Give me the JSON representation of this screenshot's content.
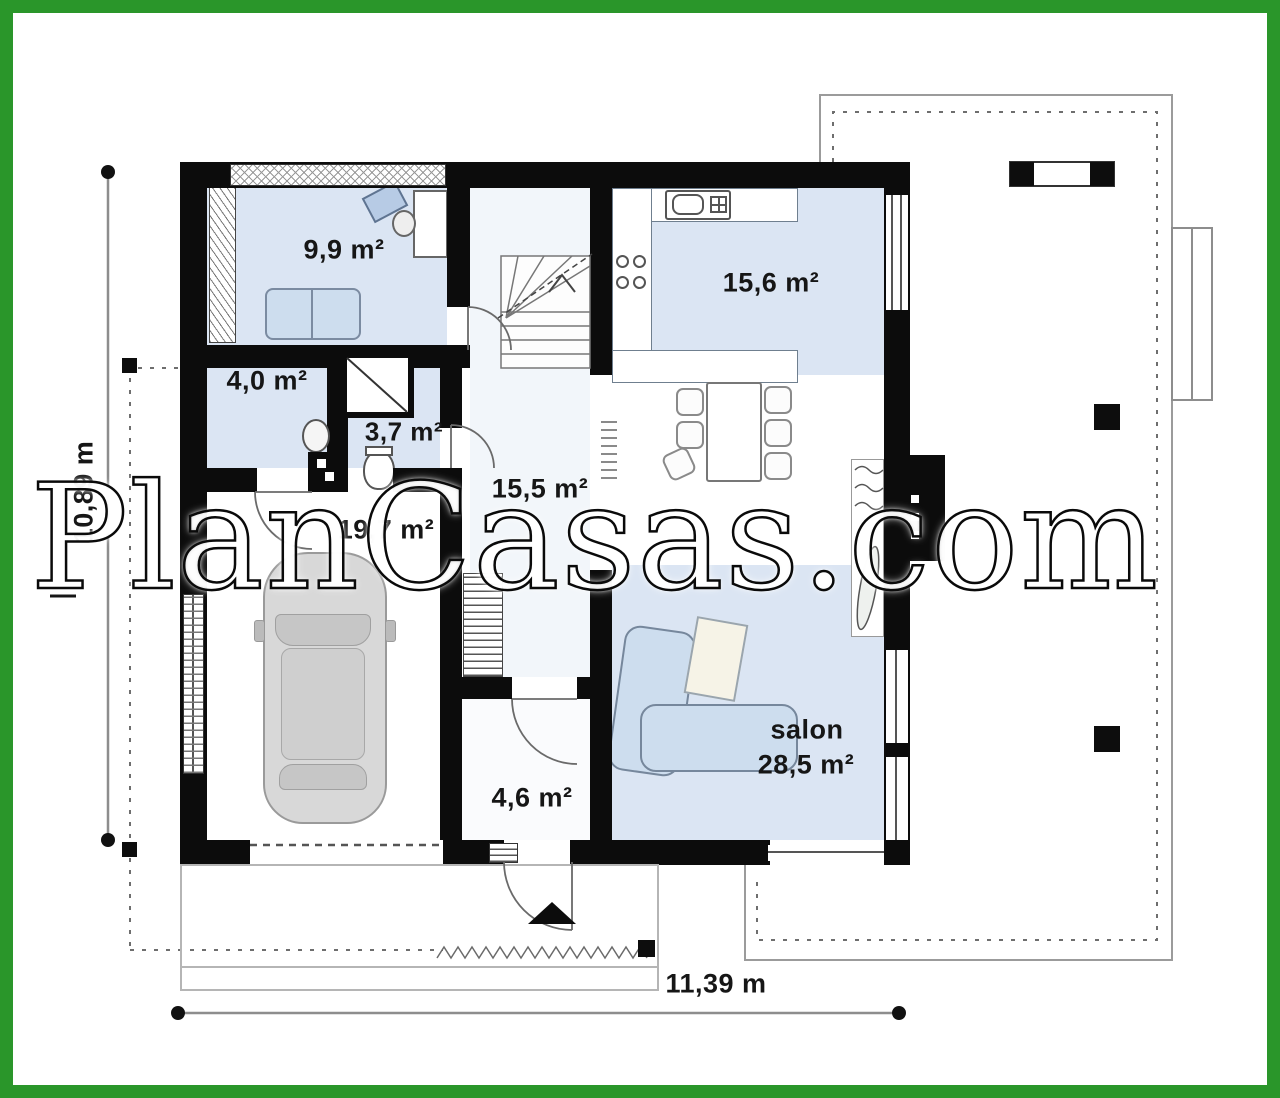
{
  "watermark": {
    "text": "PlanCasas.com"
  },
  "plan": {
    "rooms": [
      {
        "key": "office",
        "area": "9,9 m²"
      },
      {
        "key": "storage",
        "area": "4,0 m²"
      },
      {
        "key": "bathroom",
        "area": "3,7 m²"
      },
      {
        "key": "kitchen",
        "area": "15,6 m²"
      },
      {
        "key": "hall",
        "area": "15,5 m²"
      },
      {
        "key": "garage",
        "area": "19,7 m²"
      },
      {
        "key": "vestibule",
        "area": "4,6 m²"
      },
      {
        "key": "salon",
        "name": "salon",
        "area": "28,5 m²"
      }
    ],
    "dimensions": {
      "width": "11,39 m",
      "height": "10,89 m"
    }
  },
  "colors": {
    "frame_green": "#2a962a",
    "wall_black": "#0c0c0c",
    "room_fill_blue": "#dbe5f3",
    "furniture_blue": "#cdddee",
    "line_gray": "#8d8d8d"
  }
}
